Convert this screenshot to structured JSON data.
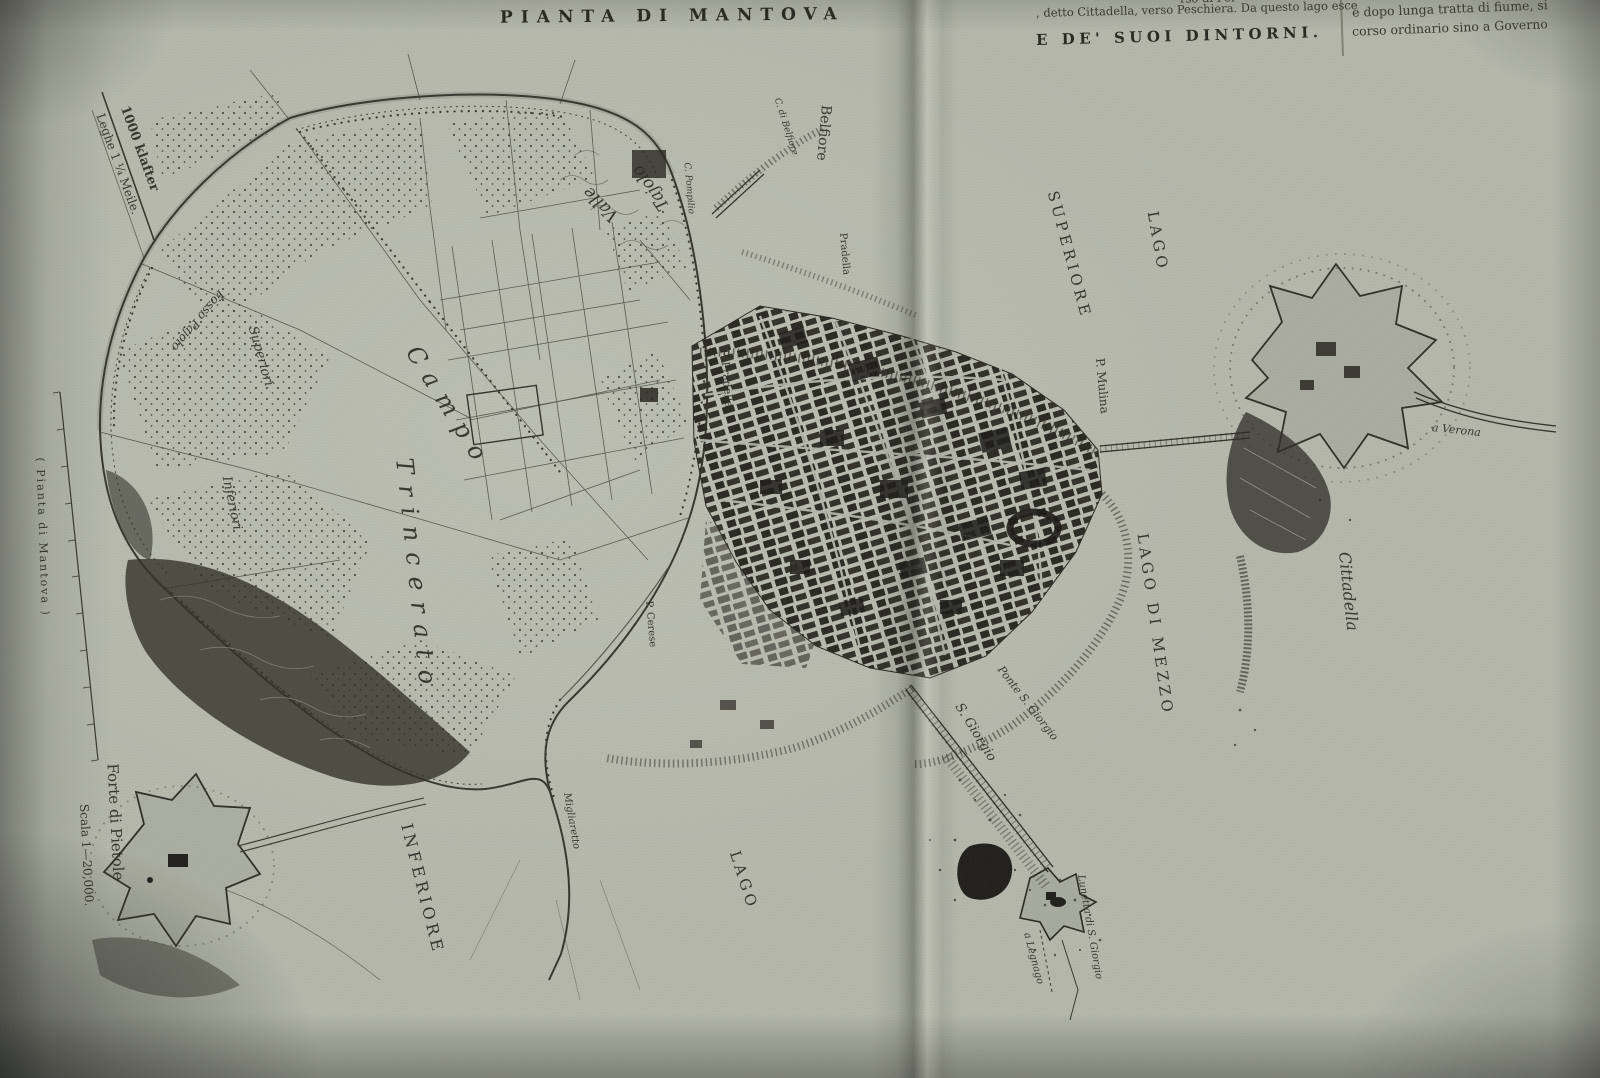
{
  "page": {
    "title": "PIANTA DI MANTOVA",
    "subtitle": "E DE' SUOI DINTORNI.",
    "article": {
      "left_tail": "rso di Por-",
      "left_line": ", detto Cittadella, verso Peschiera. Da questo lago esce",
      "right_line1": "e dopo lunga tratta di fiume, si",
      "right_line2": "corso ordinario sino a Governo"
    },
    "ink_color": "#2f2e27",
    "paper_color": "#b4b7aa"
  },
  "map_labels": [
    {
      "id": "belfiore",
      "text": "Belfiore",
      "x": 826,
      "y": 98,
      "rot": 95,
      "fs": 14,
      "cls": "roman"
    },
    {
      "id": "c-di-belfiore",
      "text": "C. di Belfiore",
      "x": 776,
      "y": 94,
      "rot": 72,
      "fs": 9,
      "cls": "ital"
    },
    {
      "id": "c-pompilio",
      "text": "C. Pompilio",
      "x": 686,
      "y": 158,
      "rot": 85,
      "fs": 9,
      "cls": "ital"
    },
    {
      "id": "valle",
      "text": "Valle",
      "x": 616,
      "y": 210,
      "rot": -135,
      "fs": 17,
      "cls": "ital"
    },
    {
      "id": "tajolo",
      "text": "Tajolo",
      "x": 666,
      "y": 200,
      "rot": -125,
      "fs": 17,
      "cls": "ital"
    },
    {
      "id": "fosso-pajolo",
      "text": "Fosso Pajolo",
      "x": 222,
      "y": 286,
      "rot": 130,
      "fs": 12,
      "cls": "ital"
    },
    {
      "id": "superiori",
      "text": "Superiori",
      "x": 252,
      "y": 320,
      "rot": 74,
      "fs": 13,
      "cls": "ital"
    },
    {
      "id": "inferiori",
      "text": "Inferiori",
      "x": 226,
      "y": 470,
      "rot": 78,
      "fs": 13,
      "cls": "ital"
    },
    {
      "id": "campo",
      "text": "Campo",
      "x": 412,
      "y": 336,
      "rot": 58,
      "fs": 24,
      "cls": "ital sp2"
    },
    {
      "id": "trincerato",
      "text": "Trincerato",
      "x": 404,
      "y": 446,
      "rot": 84,
      "fs": 24,
      "cls": "ital sp2"
    },
    {
      "id": "p-pradella",
      "text": "P. Pradella",
      "x": 724,
      "y": 344,
      "rot": 85,
      "fs": 11,
      "cls": "roman"
    },
    {
      "id": "pradella",
      "text": "Pradella",
      "x": 842,
      "y": 228,
      "rot": 85,
      "fs": 10,
      "cls": "roman"
    },
    {
      "id": "p-mulina",
      "text": "P. Mulina",
      "x": 1100,
      "y": 352,
      "rot": 85,
      "fs": 12,
      "cls": "roman"
    },
    {
      "id": "lago-superiore-lago",
      "text": "LAGO",
      "x": 1152,
      "y": 204,
      "rot": 80,
      "fs": 15,
      "cls": "sp"
    },
    {
      "id": "lago-superiore-sup",
      "text": "SUPERIORE",
      "x": 1052,
      "y": 184,
      "rot": 75,
      "fs": 15,
      "cls": "sp"
    },
    {
      "id": "lago-di-mezzo",
      "text": "LAGO DI MEZZO",
      "x": 1142,
      "y": 526,
      "rot": 82,
      "fs": 15,
      "cls": "sp"
    },
    {
      "id": "cittadella",
      "text": "Cittadella",
      "x": 1344,
      "y": 544,
      "rot": 84,
      "fs": 16,
      "cls": "ital"
    },
    {
      "id": "a-verona",
      "text": "a Verona",
      "x": 1432,
      "y": 422,
      "rot": 6,
      "fs": 11,
      "cls": "ital"
    },
    {
      "id": "s-giorgio",
      "text": "S. Giorgio",
      "x": 958,
      "y": 698,
      "rot": 58,
      "fs": 13,
      "cls": "ital"
    },
    {
      "id": "ponte-s-giorgio",
      "text": "Ponte S. Giorgio",
      "x": 1000,
      "y": 662,
      "rot": 52,
      "fs": 11,
      "cls": "ital"
    },
    {
      "id": "lunetta-di-s-giorgio",
      "text": "Lunetta di S. Giorgio",
      "x": 1080,
      "y": 870,
      "rot": 80,
      "fs": 10,
      "cls": "ital"
    },
    {
      "id": "a-legnago",
      "text": "a Legnago",
      "x": 1026,
      "y": 928,
      "rot": 75,
      "fs": 10,
      "cls": "ital"
    },
    {
      "id": "lago-inferiore-lago",
      "text": "LAGO",
      "x": 734,
      "y": 844,
      "rot": 72,
      "fs": 15,
      "cls": "sp"
    },
    {
      "id": "lago-inferiore-inf",
      "text": "INFERIORE",
      "x": 406,
      "y": 816,
      "rot": 76,
      "fs": 16,
      "cls": "sp"
    },
    {
      "id": "migliaretto",
      "text": "Migliaretto",
      "x": 566,
      "y": 788,
      "rot": 80,
      "fs": 10,
      "cls": "ital"
    },
    {
      "id": "p-cerese",
      "text": "P. Cerese",
      "x": 648,
      "y": 596,
      "rot": 85,
      "fs": 10,
      "cls": "roman"
    },
    {
      "id": "forte-di-pietole",
      "text": "Forte di Pietole",
      "x": 112,
      "y": 756,
      "rot": 87,
      "fs": 15,
      "cls": "roman"
    },
    {
      "id": "scala",
      "text": "Scala 1—20,000.",
      "x": 84,
      "y": 798,
      "rot": 87,
      "fs": 12,
      "cls": "roman"
    },
    {
      "id": "klafter",
      "text": "1000 klafter",
      "x": 124,
      "y": 100,
      "rot": 70,
      "fs": 13,
      "cls": "roman bold"
    },
    {
      "id": "leghe",
      "text": "Leghe 1 ¼ Meile.",
      "x": 100,
      "y": 108,
      "rot": 70,
      "fs": 12,
      "cls": "roman"
    },
    {
      "id": "margin-note",
      "text": "( Pianta di Mantova )",
      "x": 40,
      "y": 452,
      "rot": 88,
      "fs": 11,
      "cls": "roman sp1"
    }
  ]
}
